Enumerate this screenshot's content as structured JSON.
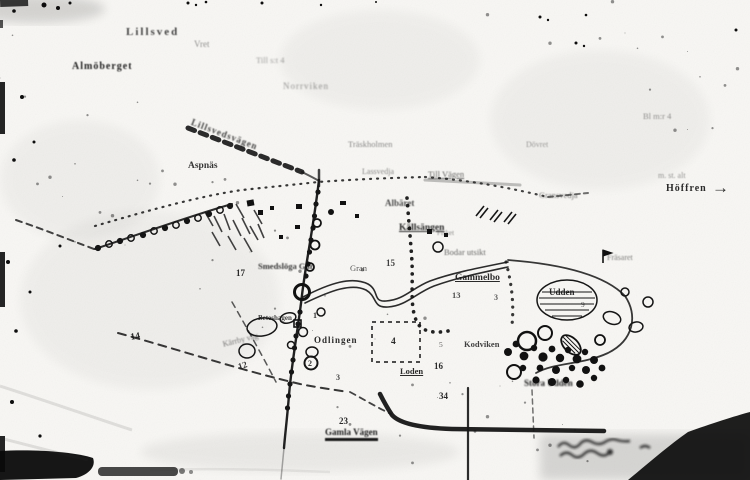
{
  "page": {
    "kind": "scanned paper map, black ink on white photocopy",
    "ink_color": "#141414",
    "paper_color": "#f8f7f4"
  },
  "map": {
    "labels": [
      {
        "id": "lillsved",
        "text": "Lillsved",
        "x": 126,
        "y": 27,
        "fs": 11,
        "b": 1,
        "ls": 2,
        "op": 0.8,
        "blur": 0.5
      },
      {
        "id": "vret",
        "text": "Vret",
        "x": 194,
        "y": 40,
        "fs": 9,
        "op": 0.45,
        "blur": 0.6
      },
      {
        "id": "almoberget",
        "text": "Almöberget",
        "x": 72,
        "y": 62,
        "fs": 10,
        "b": 1,
        "ls": 1,
        "op": 0.95,
        "blur": 0.6
      },
      {
        "id": "till-note",
        "text": "Till s:t 4",
        "x": 256,
        "y": 56,
        "fs": 8.5,
        "op": 0.4,
        "blur": 0.7
      },
      {
        "id": "norrviken",
        "text": "Norrviken",
        "x": 283,
        "y": 82,
        "fs": 9,
        "ls": 1,
        "op": 0.45,
        "blur": 0.7
      },
      {
        "id": "top-right-note",
        "text": "Bl m:r 4",
        "x": 643,
        "y": 112,
        "fs": 8.5,
        "op": 0.45,
        "blur": 0.6
      },
      {
        "id": "lillsvedsvagen",
        "text": "Lillsvedsvägen",
        "x": 193,
        "y": 118,
        "fs": 9,
        "b": 1,
        "rot": 21,
        "ls": 1,
        "op": 0.8,
        "blur": 0.5
      },
      {
        "id": "traskholmen",
        "text": "Träskholmen",
        "x": 348,
        "y": 140,
        "fs": 8.5,
        "op": 0.5,
        "blur": 0.6
      },
      {
        "id": "aspnas",
        "text": "Aspnäs",
        "x": 188,
        "y": 162,
        "fs": 9.5,
        "b": 1,
        "op": 0.85,
        "blur": 0.3
      },
      {
        "id": "lassvedja",
        "text": "Lassvedja",
        "x": 362,
        "y": 168,
        "fs": 8,
        "op": 0.5,
        "blur": 0.6
      },
      {
        "id": "till-vagen",
        "text": "Till Vägen",
        "x": 428,
        "y": 170,
        "fs": 8.5,
        "u": 1,
        "op": 0.65,
        "blur": 0.5
      },
      {
        "id": "dovret",
        "text": "Dövret",
        "x": 526,
        "y": 141,
        "fs": 8,
        "op": 0.4,
        "blur": 0.6
      },
      {
        "id": "gransvedja",
        "text": "Gransvedja",
        "x": 539,
        "y": 191,
        "fs": 8.5,
        "op": 0.55,
        "blur": 0.5
      },
      {
        "id": "stalt-note",
        "text": "m. st. alt",
        "x": 658,
        "y": 172,
        "fs": 8,
        "op": 0.45,
        "blur": 0.6
      },
      {
        "id": "hoffren",
        "text": "Höffren",
        "x": 666,
        "y": 184,
        "fs": 10,
        "b": 1,
        "ls": 1,
        "op": 0.9,
        "blur": 0.3
      },
      {
        "id": "hoffren-arrow",
        "text": "→",
        "x": 712,
        "y": 179,
        "fs": 17,
        "b": 1,
        "op": 0.9
      },
      {
        "id": "albaret",
        "text": "Albäret",
        "x": 385,
        "y": 199,
        "fs": 9,
        "b": 1,
        "op": 0.75,
        "blur": 0.5
      },
      {
        "id": "kallsangen",
        "text": "Källsängen",
        "x": 399,
        "y": 224,
        "fs": 9.5,
        "b": 1,
        "u": 1,
        "op": 0.9,
        "blur": 0.4
      },
      {
        "id": "fisket",
        "text": "Fisket",
        "x": 437,
        "y": 230,
        "fs": 7,
        "op": 0.5,
        "blur": 0.5
      },
      {
        "id": "smedsloga",
        "text": "Smedslöga Går",
        "x": 258,
        "y": 262,
        "fs": 8.5,
        "b": 1,
        "op": 0.85,
        "blur": 0.4
      },
      {
        "id": "n17",
        "text": "17",
        "x": 236,
        "y": 269,
        "fs": 9,
        "b": 1,
        "op": 0.9
      },
      {
        "id": "gran",
        "text": "Gran",
        "x": 350,
        "y": 264,
        "fs": 8.5,
        "op": 0.7,
        "blur": 0.3
      },
      {
        "id": "n15",
        "text": "15",
        "x": 386,
        "y": 259,
        "fs": 9,
        "b": 1,
        "op": 0.8
      },
      {
        "id": "bodar-utsikt",
        "text": "Bodar utsikt",
        "x": 444,
        "y": 248,
        "fs": 8.5,
        "op": 0.65,
        "blur": 0.4
      },
      {
        "id": "gammelbo",
        "text": "Gammelbo",
        "x": 455,
        "y": 274,
        "fs": 9.5,
        "b": 1,
        "u": 1,
        "op": 0.9,
        "blur": 0.3
      },
      {
        "id": "frasaret",
        "text": "Fräsaret",
        "x": 607,
        "y": 254,
        "fs": 8,
        "op": 0.55,
        "blur": 0.4
      },
      {
        "id": "udden",
        "text": "Udden",
        "x": 549,
        "y": 288,
        "fs": 9,
        "b": 1,
        "op": 0.9,
        "blur": 0.3
      },
      {
        "id": "n13",
        "text": "13",
        "x": 452,
        "y": 291,
        "fs": 8.5,
        "b": 1,
        "op": 0.75
      },
      {
        "id": "n3b",
        "text": "3",
        "x": 494,
        "y": 294,
        "fs": 8,
        "b": 1,
        "op": 0.7
      },
      {
        "id": "n9",
        "text": "9",
        "x": 581,
        "y": 301,
        "fs": 7.5,
        "op": 0.7
      },
      {
        "id": "beteshagen",
        "text": "Beteshagen",
        "x": 258,
        "y": 315,
        "fs": 7,
        "b": 1,
        "op": 0.8
      },
      {
        "id": "n1",
        "text": "1",
        "x": 313,
        "y": 312,
        "fs": 8,
        "b": 1,
        "op": 0.85
      },
      {
        "id": "karrby-vag",
        "text": "Kärrby väg",
        "x": 222,
        "y": 341,
        "fs": 8,
        "rot": -14,
        "op": 0.55,
        "blur": 0.4
      },
      {
        "id": "n14",
        "text": "14",
        "x": 130,
        "y": 334,
        "fs": 9.5,
        "b": 1,
        "rot": -10,
        "op": 0.9
      },
      {
        "id": "n12",
        "text": "12",
        "x": 237,
        "y": 363,
        "fs": 9,
        "b": 1,
        "rot": -18,
        "op": 0.85
      },
      {
        "id": "odlingen",
        "text": "Odlingen",
        "x": 314,
        "y": 336,
        "fs": 9,
        "b": 1,
        "ls": 1,
        "op": 0.9
      },
      {
        "id": "n4",
        "text": "4",
        "x": 391,
        "y": 338,
        "fs": 9.5,
        "b": 1,
        "op": 0.9
      },
      {
        "id": "kodviken",
        "text": "Kodviken",
        "x": 464,
        "y": 340,
        "fs": 8.5,
        "b": 1,
        "op": 0.8,
        "blur": 0.3
      },
      {
        "id": "n2",
        "text": "2",
        "x": 308,
        "y": 360,
        "fs": 8,
        "b": 1,
        "op": 0.9
      },
      {
        "id": "n5",
        "text": "5",
        "x": 439,
        "y": 341,
        "fs": 7.5,
        "op": 0.7
      },
      {
        "id": "loden",
        "text": "Loden",
        "x": 400,
        "y": 367,
        "fs": 8.5,
        "b": 1,
        "u": 1,
        "op": 0.9
      },
      {
        "id": "n16",
        "text": "16",
        "x": 434,
        "y": 362,
        "fs": 9,
        "b": 1,
        "op": 0.9
      },
      {
        "id": "n3",
        "text": "3",
        "x": 336,
        "y": 374,
        "fs": 8,
        "b": 1,
        "op": 0.8
      },
      {
        "id": "n34",
        "text": "34",
        "x": 439,
        "y": 392,
        "fs": 9,
        "b": 1,
        "op": 0.9
      },
      {
        "id": "n23",
        "text": "23",
        "x": 339,
        "y": 417,
        "fs": 9,
        "b": 1,
        "op": 0.9
      },
      {
        "id": "gamla-vagen",
        "text": "Gamla Vägen",
        "x": 325,
        "y": 428,
        "fs": 9,
        "b": 1,
        "hu": 1,
        "op": 0.95,
        "blur": 0.5
      },
      {
        "id": "stora-udden",
        "text": "Stora Udden",
        "x": 524,
        "y": 379,
        "fs": 9,
        "b": 1,
        "op": 0.95,
        "blur": 0.8
      }
    ]
  }
}
